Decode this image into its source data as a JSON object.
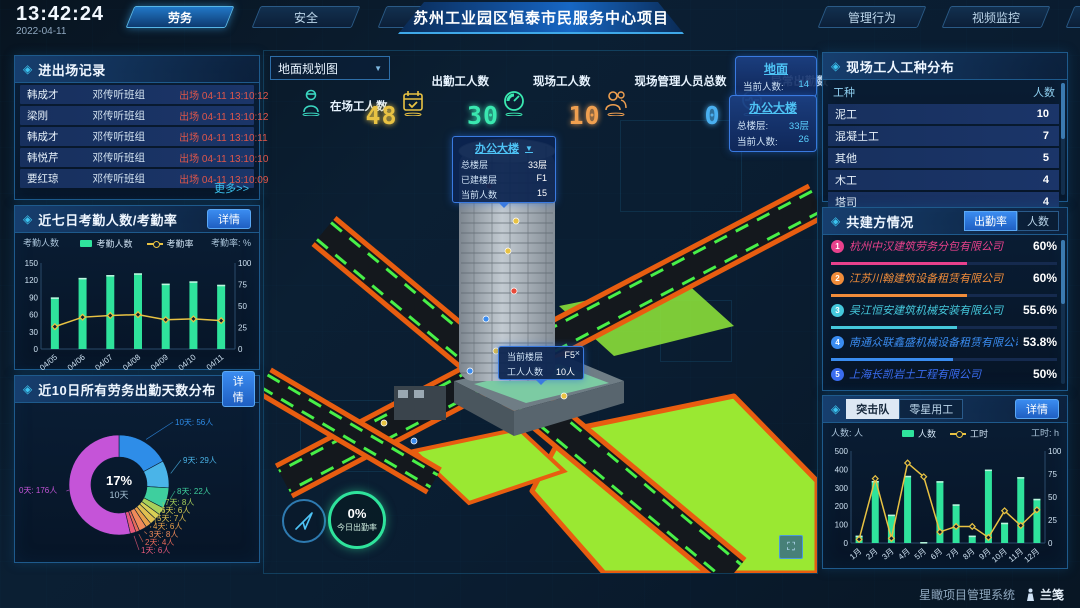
{
  "header": {
    "time": "13:42:24",
    "date": "2022-04-11",
    "left_tabs": [
      {
        "label": "劳务",
        "active": true
      },
      {
        "label": "安全",
        "active": false
      },
      {
        "label": "工期",
        "active": false
      }
    ],
    "title": "苏州工业园区恒泰市民服务中心项目",
    "right_tabs": [
      {
        "label": "管理行为",
        "active": false
      },
      {
        "label": "视频监控",
        "active": false
      },
      {
        "label": "热力图",
        "active": false
      }
    ]
  },
  "entry_exit_panel": {
    "title": "进出场记录",
    "more_link": "更多>>",
    "records": [
      {
        "name": "韩成才",
        "team": "邓传听班组",
        "event": "出场 04-11 13:10:12"
      },
      {
        "name": "梁刚",
        "team": "邓传听班组",
        "event": "出场 04-11 13:10:12"
      },
      {
        "name": "韩成才",
        "team": "邓传听班组",
        "event": "出场 04-11 13:10:11"
      },
      {
        "name": "韩悦芹",
        "team": "邓传听班组",
        "event": "出场 04-11 13:10:10"
      },
      {
        "name": "要红琼",
        "team": "邓传听班组",
        "event": "出场 04-11 13:10:09"
      }
    ]
  },
  "attendance_panel": {
    "title": "近七日考勤人数/考勤率",
    "detail_button": "详情",
    "left_axis_caption": "考勤人数",
    "right_axis_caption": "考勤率: %",
    "chart_data": {
      "type": "bar",
      "categories": [
        "04/05",
        "04/06",
        "04/07",
        "04/08",
        "04/09",
        "04/10",
        "04/11"
      ],
      "series": [
        {
          "name": "考勤人数",
          "kind": "bar",
          "color": "#2fe39c",
          "axis": "left",
          "values": [
            90,
            124,
            129,
            132,
            114,
            118,
            112
          ]
        },
        {
          "name": "考勤率",
          "kind": "line",
          "color": "#e8c243",
          "axis": "right",
          "values": [
            26,
            37,
            39,
            40,
            34,
            35,
            33
          ]
        }
      ],
      "y_left": {
        "label": "考勤人数",
        "ticks": [
          0,
          30,
          60,
          90,
          120,
          150
        ],
        "max": 150
      },
      "y_right": {
        "label": "考勤率: %",
        "ticks": [
          0,
          25,
          50,
          75,
          100
        ],
        "max": 100
      },
      "legend_position": "top"
    }
  },
  "distribution_panel": {
    "title": "近10日所有劳务出勤天数分布",
    "detail_button": "详情",
    "center_percent": "17%",
    "center_label": "10天",
    "chart_data": {
      "type": "pie",
      "title": "近10日所有劳务出勤天数分布",
      "unit": "人",
      "segments": [
        {
          "label": "10天",
          "value": 56,
          "color": "#2e8de8"
        },
        {
          "label": "9天",
          "value": 29,
          "color": "#4ab4e8"
        },
        {
          "label": "8天",
          "value": 22,
          "color": "#3ecf9e"
        },
        {
          "label": "7天",
          "value": 8,
          "color": "#a8d05a"
        },
        {
          "label": "6天",
          "value": 6,
          "color": "#d8d055"
        },
        {
          "label": "5天",
          "value": 7,
          "color": "#e0c050"
        },
        {
          "label": "4天",
          "value": 6,
          "color": "#e8a04a"
        },
        {
          "label": "3天",
          "value": 8,
          "color": "#ef8a5a"
        },
        {
          "label": "2天",
          "value": 4,
          "color": "#e86a5a"
        },
        {
          "label": "1天",
          "value": 6,
          "color": "#e85a7a"
        },
        {
          "label": "0天",
          "value": 176,
          "color": "#c554d8"
        }
      ]
    }
  },
  "scene": {
    "dropdown_value": "地面规划图",
    "stats": [
      {
        "icon": "worker-icon",
        "label": "在场工人数",
        "value": "",
        "color": "#3ad6c0"
      },
      {
        "icon": "calendar-icon",
        "label": "出勤工人数",
        "value": "48",
        "color": "#e8c243"
      },
      {
        "icon": "gauge-icon",
        "label": "现场工人数",
        "value": "30",
        "color": "#3ae8b0"
      },
      {
        "icon": "people-icon",
        "label": "现场管理人员总数",
        "value": "10",
        "color": "#f0a050"
      },
      {
        "icon": "pulse-icon",
        "label": "异常出勤数",
        "value": "0",
        "color": "#4ab0f0"
      }
    ],
    "cards": [
      {
        "title": "地面",
        "rows": [
          {
            "label": "当前人数:",
            "value": "14"
          }
        ]
      },
      {
        "title": "办公大楼",
        "rows": [
          {
            "label": "总楼层:",
            "value": "33层"
          },
          {
            "label": "当前人数:",
            "value": "26"
          }
        ]
      }
    ],
    "building_tooltip": {
      "title": "办公大楼",
      "rows": [
        {
          "label": "总楼层",
          "value": "33层"
        },
        {
          "label": "已建楼层",
          "value": "F1"
        },
        {
          "label": "当前人数",
          "value": "15"
        }
      ]
    },
    "floor_tooltip": {
      "rows": [
        {
          "label": "当前楼层",
          "value": "F5"
        },
        {
          "label": "工人人数",
          "value": "10人"
        }
      ],
      "close": "×"
    },
    "attendance_badge": {
      "percent": "0%",
      "caption": "今日出勤率"
    }
  },
  "worker_type_panel": {
    "title": "现场工人工种分布",
    "col_type": "工种",
    "col_count": "人数",
    "rows": [
      {
        "type": "泥工",
        "count": "10"
      },
      {
        "type": "混凝土工",
        "count": "7"
      },
      {
        "type": "其他",
        "count": "5"
      },
      {
        "type": "木工",
        "count": "4"
      },
      {
        "type": "塔司",
        "count": "4"
      }
    ]
  },
  "partners_panel": {
    "title": "共建方情况",
    "toggle": [
      {
        "label": "出勤率",
        "active": true
      },
      {
        "label": "人数",
        "active": false
      }
    ],
    "companies": [
      {
        "rank": "1",
        "name": "杭州中汉建筑劳务分包有限公司",
        "value": "60%",
        "pct": 60,
        "color": "#e8418c"
      },
      {
        "rank": "2",
        "name": "江苏川翰建筑设备租赁有限公司",
        "value": "60%",
        "pct": 60,
        "color": "#f08c3a"
      },
      {
        "rank": "3",
        "name": "吴江恒安建筑机械安装有限公司",
        "value": "55.6%",
        "pct": 55.6,
        "color": "#45c8dc"
      },
      {
        "rank": "4",
        "name": "南通众联鑫盛机械设备租赁有限公司",
        "value": "53.8%",
        "pct": 53.8,
        "color": "#3a8cf0"
      },
      {
        "rank": "5",
        "name": "上海长凯岩土工程有限公司",
        "value": "50%",
        "pct": 50,
        "color": "#3a6cf0"
      },
      {
        "rank": "6",
        "name": "江苏浩治建筑安装工程有限公司",
        "value": "35.4%",
        "pct": 35.4,
        "color": "#8c54d8"
      }
    ]
  },
  "monthly_panel": {
    "tabs": [
      {
        "label": "突击队",
        "active": true
      },
      {
        "label": "零星用工",
        "active": false
      }
    ],
    "detail_button": "详情",
    "left_axis_caption": "人数: 人",
    "right_axis_caption": "工时: h",
    "chart_data": {
      "type": "bar",
      "categories": [
        "1月",
        "2月",
        "3月",
        "4月",
        "5月",
        "6月",
        "7月",
        "8月",
        "9月",
        "10月",
        "11月",
        "12月"
      ],
      "series": [
        {
          "name": "人数",
          "kind": "bar",
          "color": "#2fe39c",
          "axis": "left",
          "values": [
            40,
            337,
            154,
            365,
            5,
            336,
            210,
            40,
            399,
            110,
            358,
            240
          ]
        },
        {
          "name": "工时",
          "kind": "line",
          "color": "#e8c243",
          "axis": "right",
          "values": [
            4,
            70,
            5,
            87,
            72,
            12,
            18,
            18,
            6,
            35,
            19,
            36
          ]
        }
      ],
      "y_left": {
        "label": "人数: 人",
        "ticks": [
          0,
          100,
          200,
          300,
          400,
          500
        ],
        "max": 500
      },
      "y_right": {
        "label": "工时: h",
        "ticks": [
          0,
          25,
          50,
          75,
          100
        ],
        "max": 100
      },
      "legend_position": "top"
    }
  },
  "footer": {
    "system_name": "星瞰项目管理系统",
    "logo_text": "兰笺"
  }
}
